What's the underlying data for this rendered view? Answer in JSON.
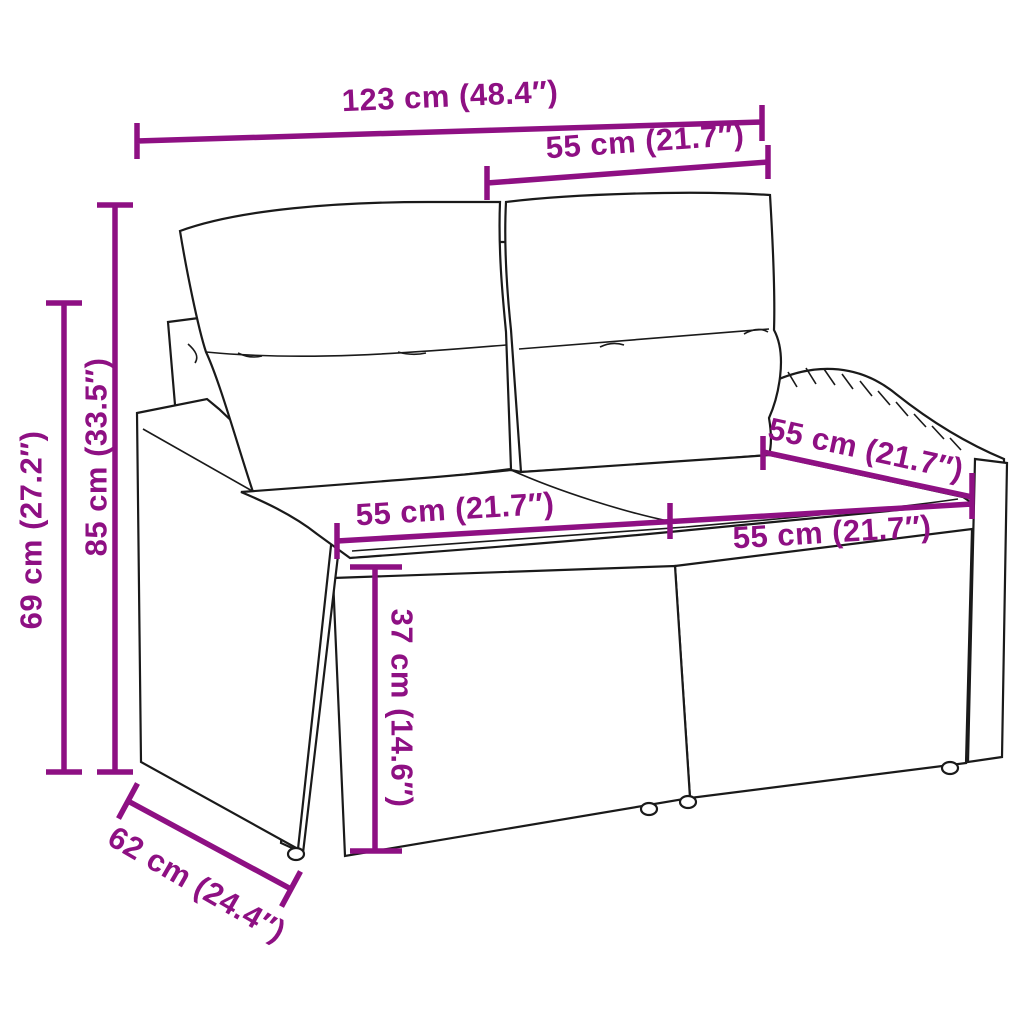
{
  "title": "Poly rattan garden loveseat with cushions – dimension diagram",
  "colors": {
    "dimension_accent": "#8E1083",
    "sketch_line": "#1A1A1A",
    "background": "#FFFFFF",
    "cushion_fill": "#FFFFFF"
  },
  "dims": {
    "width_overall": {
      "label": "123 cm (48.4″)"
    },
    "backrest_width_top": {
      "label": "55 cm (21.7″)"
    },
    "height_overall": {
      "label": "85 cm (33.5″)"
    },
    "armrest_height": {
      "label": "69 cm (27.2″)"
    },
    "seat_width_left": {
      "label": "55 cm (21.7″)"
    },
    "seat_width_right": {
      "label": "55 cm (21.7″)"
    },
    "seat_depth_right": {
      "label": "55 cm (21.7″)"
    },
    "seat_height": {
      "label": "37 cm (14.6″)"
    },
    "depth_overall": {
      "label": "62 cm (24.4″)"
    }
  }
}
